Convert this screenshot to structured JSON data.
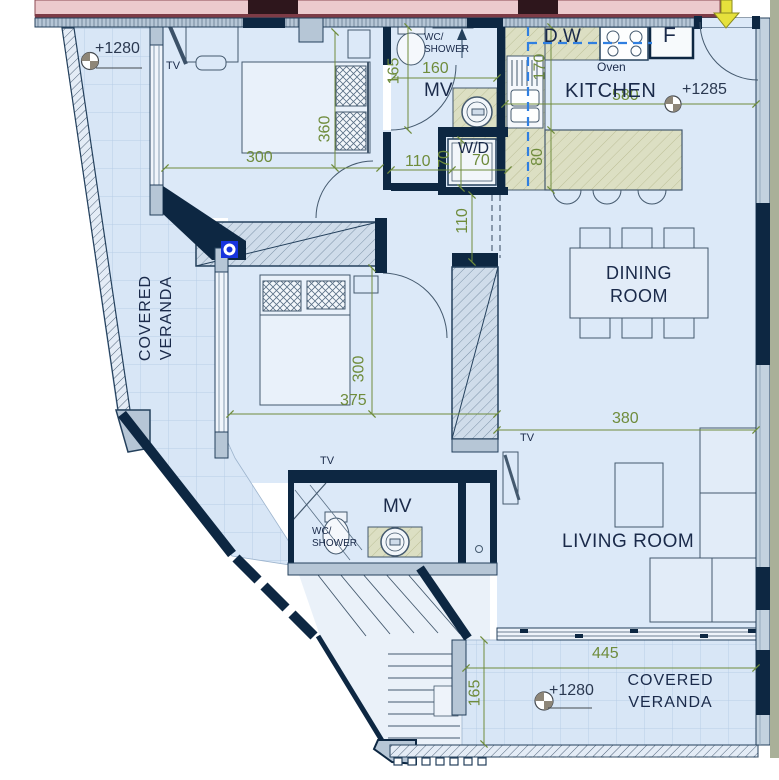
{
  "labels": {
    "level_veranda_left": "+1280",
    "level_kitchen": "+1285",
    "level_veranda_bottom": "+1280",
    "tv_bedroom1": "TV",
    "tv_bedroom2": "TV",
    "tv_living": "TV",
    "wc_line1": "WC/",
    "wc_line2": "SHOWER",
    "mv_top": "MV",
    "mv_bottom": "MV",
    "wd": "W/D",
    "dw": "D.W",
    "oven": "Oven",
    "fridge": "F",
    "kitchen": "KITCHEN",
    "dining_1": "DINING",
    "dining_2": "ROOM",
    "living": "LIVING ROOM",
    "veranda_1": "COVERED",
    "veranda_2": "VERANDA"
  },
  "dimensions": {
    "bedroom1_width": "300",
    "bedroom1_depth": "360",
    "wc_top_depth": "165",
    "wc_top_width": "160",
    "hall_width": "110",
    "wd_width": "70",
    "wd_depth": "70",
    "kitchen_counter_depth": "170",
    "island_depth": "80",
    "corridor_width": "110",
    "kitchen_width": "580",
    "bedroom2_width": "375",
    "bedroom2_depth": "300",
    "living_width": "380",
    "veranda_bottom_width": "445",
    "veranda_bottom_depth": "165"
  },
  "colors": {
    "floor": "#d9e7f8",
    "wall_dark": "#0d2742",
    "wall_light": "#b6c6d6",
    "counter_beige": "#dcdfc3",
    "dimension_green": "#6f8c3c",
    "plumbing_dashed_blue": "#2f7fe0",
    "party_wall_pink": "#eccacd",
    "entry_arrow_yellow": "#e6e13c",
    "fixture_blue": "#1633dd"
  }
}
